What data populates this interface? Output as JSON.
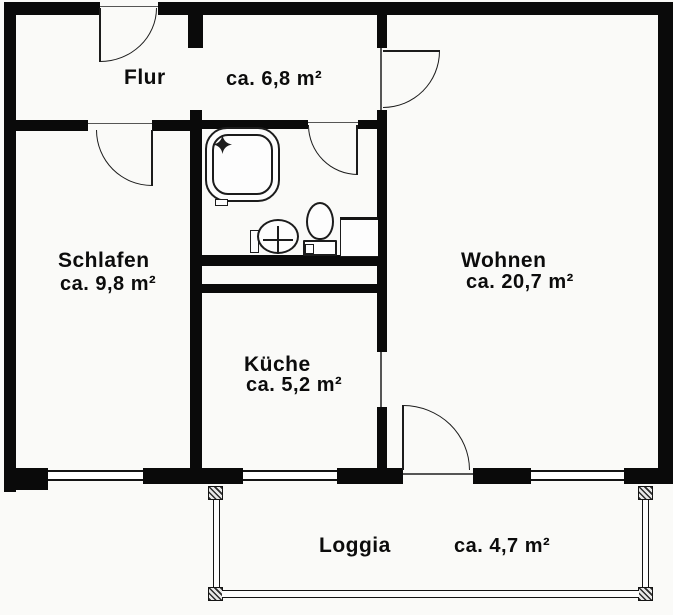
{
  "plan_title": "floor-plan",
  "rooms": {
    "flur": {
      "name": "Flur",
      "area": "ca. 6,8 m²"
    },
    "schlafen": {
      "name": "Schlafen",
      "area": "ca. 9,8 m²"
    },
    "wohnen": {
      "name": "Wohnen",
      "area": "ca. 20,7 m²"
    },
    "kueche": {
      "name": "Küche",
      "area": "ca. 5,2 m²"
    },
    "loggia": {
      "name": "Loggia",
      "area": "ca. 4,7 m²"
    }
  },
  "icons": {
    "shower": "shower-tray-icon",
    "shower_star": "sparkle-star-icon",
    "sink": "washbasin-icon",
    "toilet": "toilet-icon",
    "counter": "bath-counter-icon",
    "columns": "hatched-column-icon"
  },
  "colors": {
    "wall": "#0a0a0a",
    "line": "#1c1c1c",
    "paper": "#fafaf8"
  }
}
